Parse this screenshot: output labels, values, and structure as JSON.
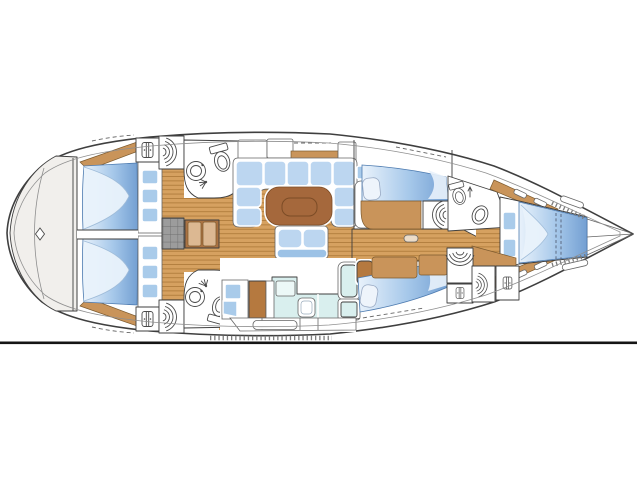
{
  "diagram": {
    "type": "yacht-interior-deck-plan",
    "orientation": {
      "bow": "right",
      "stern": "left"
    },
    "areas": [
      {
        "id": "stern-deck",
        "name": "rounded stern deck with deck fitting"
      },
      {
        "id": "aft-cabin-top",
        "name": "aft double cabin, top side"
      },
      {
        "id": "aft-cabin-bottom",
        "name": "aft double cabin, bottom side"
      },
      {
        "id": "aft-head-top",
        "name": "aft head with toilet and sink, top side"
      },
      {
        "id": "aft-head-bottom",
        "name": "aft head with toilet and sink, bottom side"
      },
      {
        "id": "companionway",
        "name": "companionway steps with engine box"
      },
      {
        "id": "salon",
        "name": "salon with U-settee, table and bench"
      },
      {
        "id": "galley",
        "name": "galley with counters, sink and fridge"
      },
      {
        "id": "mid-cabin-top",
        "name": "single-berth cabin, top side"
      },
      {
        "id": "mid-cabin-bottom",
        "name": "single-berth cabin, bottom side"
      },
      {
        "id": "forward-head",
        "name": "forward head with toilet and sink"
      },
      {
        "id": "forward-cabin",
        "name": "forward V-berth cabin"
      },
      {
        "id": "forepeak",
        "name": "bow locker / forepeak"
      }
    ],
    "icons": [
      "toilet-icon",
      "sink-icon",
      "shower-icon",
      "wardrobe-icon",
      "vent-arcs-icon",
      "deck-fitting-diamond-icon"
    ],
    "fixture_counts": {
      "toilets": 3,
      "sinks": 3,
      "double_beds": 3,
      "single_berths": 2
    }
  },
  "palette": {
    "bg": "#ffffff",
    "outline": "#3f3f3f",
    "outlineMid": "#666666",
    "outlineSoft": "#8f8f8f",
    "white": "#ffffff",
    "sternDeck": "#f1efec",
    "floorWood": "#d6a160",
    "floorPlank": "#b07c3c",
    "shelfWood": "#c9945a",
    "shelfEdge": "#7c5a2e",
    "tableWood": "#a5683c",
    "tableInner": "#7c4c26",
    "stepsWood": "#aa7242",
    "stepsPanel": "#dcb892",
    "cushion": "#bcd6f0",
    "benchBack": "#9cc2e6",
    "lockerBlue": "#a9cbea",
    "counterCyan": "#d9efee",
    "counterCyanLight": "#ecf8f7",
    "galleyBrown": "#b5793f",
    "grayBox": "#9c9c9c",
    "grayGrid": "#6e6e6e",
    "bedLight": "#e9f2fb",
    "bedMid": "#a6c8ea",
    "bedDeep": "#739fd2",
    "bedEdge": "#4d7bb0",
    "foldLine": "#9fbcd9",
    "pillow": "#eef4fb",
    "iconStroke": "#4a4a4a",
    "tickGray": "#7d7d7d",
    "baseline": "#151515"
  }
}
